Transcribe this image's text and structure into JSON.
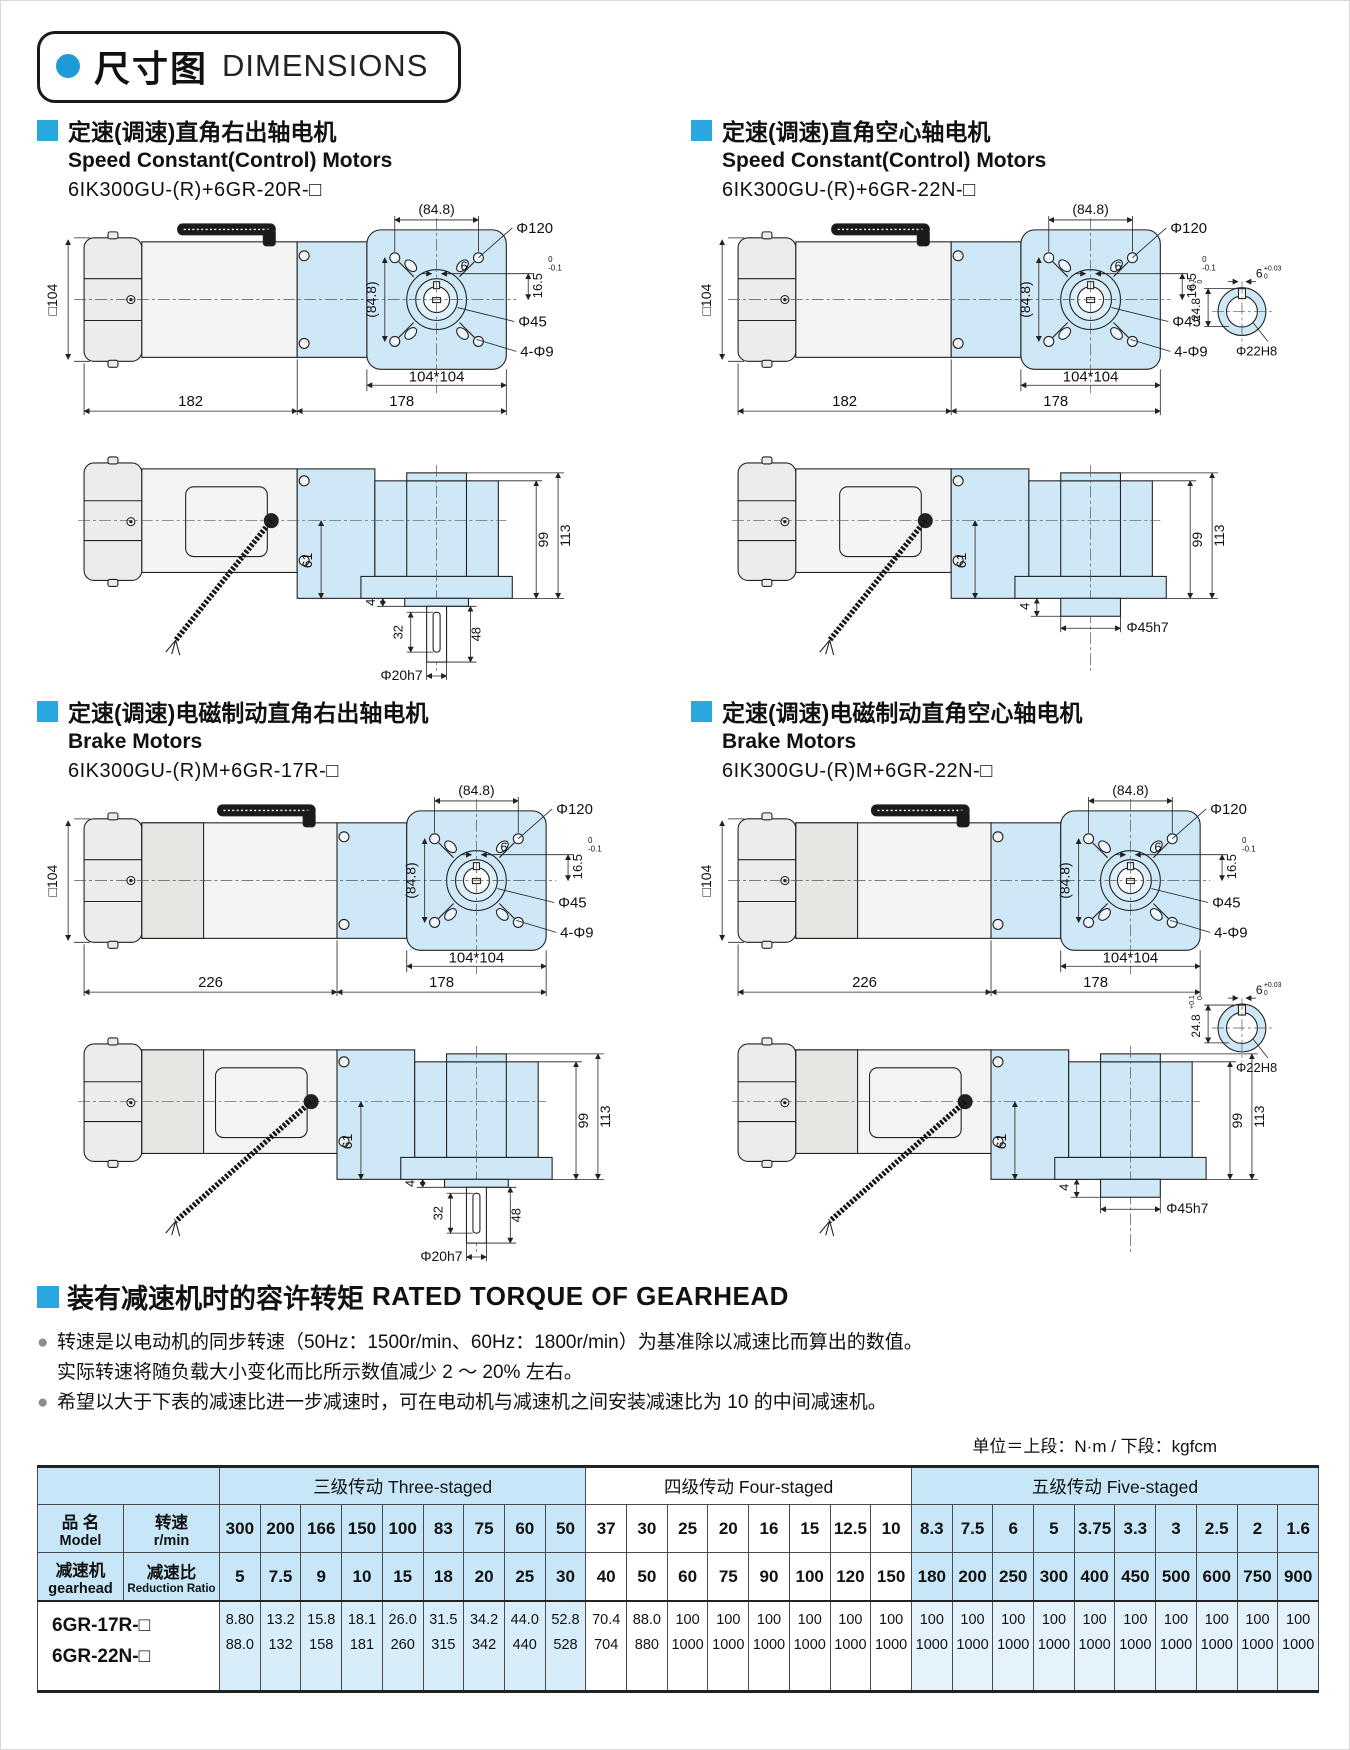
{
  "header": {
    "title_zh": "尺寸图",
    "title_en": "DIMENSIONS",
    "dot_color": "#1e9bd7"
  },
  "accent_blue": "#29a8e0",
  "gearhead_fill": "#cfe8f7",
  "sections": [
    {
      "key": "s1",
      "title_zh": "定速(调速)直角右出轴电机",
      "title_en": "Speed Constant(Control) Motors",
      "model": "6IK300GU-(R)+6GR-20R-□",
      "length_label": "182",
      "variant": {
        "brake": false,
        "hollow": false
      }
    },
    {
      "key": "s2",
      "title_zh": "定速(调速)直角空心轴电机",
      "title_en": "Speed Constant(Control) Motors",
      "model": "6IK300GU-(R)+6GR-22N-□",
      "length_label": "182",
      "variant": {
        "brake": false,
        "hollow": true
      }
    },
    {
      "key": "s3",
      "title_zh": "定速(调速)电磁制动直角右出轴电机",
      "title_en": "Brake Motors",
      "model": "6IK300GU-(R)M+6GR-17R-□",
      "length_label": "226",
      "variant": {
        "brake": true,
        "hollow": false
      }
    },
    {
      "key": "s4",
      "title_zh": "定速(调速)电磁制动直角空心轴电机",
      "title_en": "Brake Motors",
      "model": "6IK300GU-(R)M+6GR-22N-□",
      "length_label": "226",
      "variant": {
        "brake": true,
        "hollow": true
      }
    }
  ],
  "dims": {
    "sq104": "□104",
    "w848": "(84.8)",
    "dia120": "Φ120",
    "six": "6",
    "d165": "16.5",
    "d165_tol_hi": "0",
    "d165_tol_lo": "-0.1",
    "dia45": "Φ45",
    "holes": "4-Φ9",
    "plate104": "104*104",
    "len178": "178",
    "h61": "61",
    "h99": "99",
    "h113": "113",
    "s4": "4",
    "s32": "32",
    "s48": "48",
    "dia20h7": "Φ20h7",
    "dia45h7": "Φ45h7",
    "key6_tol_hi": "+0.03",
    "key6_tol_lo": "0",
    "key248": "24.8",
    "key248_tol_hi": "+0.1",
    "key248_tol_lo": "0",
    "dia22h8": "Φ22H8"
  },
  "torque": {
    "title_zh": "装有减速机时的容许转矩",
    "title_en": "RATED TORQUE OF GEARHEAD",
    "notes": [
      {
        "bullet": "●",
        "text": "转速是以电动机的同步转速（50Hz：1500r/min、60Hz：1800r/min）为基准除以减速比而算出的数值。"
      },
      {
        "bullet": "",
        "text": "实际转速将随负载大小变化而比所示数值减少 2 ～ 20% 左右。"
      },
      {
        "bullet": "●",
        "text": "希望以大于下表的减速比进一步减速时，可在电动机与减速机之间安装减速比为 10 的中间减速机。"
      }
    ],
    "unit": "单位＝上段：N·m / 下段：kgfcm",
    "table": {
      "groups": [
        {
          "label": "三级传动 Three-staged",
          "cols": 9,
          "cls": "hb"
        },
        {
          "label": "四级传动 Four-staged",
          "cols": 8,
          "cls": "hw"
        },
        {
          "label": "五级传动 Five-staged",
          "cols": 10,
          "cls": "hb"
        }
      ],
      "head": {
        "name_zh": "品  名",
        "name_en": "Model",
        "gear_zh": "减速机",
        "gear_en": "gearhead",
        "speed_zh": "转速",
        "speed_en": "r/min",
        "ratio_zh": "减速比",
        "ratio_en": "Reduction Ratio"
      },
      "speeds": [
        "300",
        "200",
        "166",
        "150",
        "100",
        "83",
        "75",
        "60",
        "50",
        "37",
        "30",
        "25",
        "20",
        "16",
        "15",
        "12.5",
        "10",
        "8.3",
        "7.5",
        "6",
        "5",
        "3.75",
        "3.3",
        "3",
        "2.5",
        "2",
        "1.6"
      ],
      "ratios": [
        "5",
        "7.5",
        "9",
        "10",
        "15",
        "18",
        "20",
        "25",
        "30",
        "40",
        "50",
        "60",
        "75",
        "90",
        "100",
        "120",
        "150",
        "180",
        "200",
        "250",
        "300",
        "400",
        "450",
        "500",
        "600",
        "750",
        "900"
      ],
      "models": [
        "6GR-17R-□",
        "6GR-22N-□"
      ],
      "nm": [
        "8.80",
        "13.2",
        "15.8",
        "18.1",
        "26.0",
        "31.5",
        "34.2",
        "44.0",
        "52.8",
        "70.4",
        "88.0",
        "100",
        "100",
        "100",
        "100",
        "100",
        "100",
        "100",
        "100",
        "100",
        "100",
        "100",
        "100",
        "100",
        "100",
        "100",
        "100"
      ],
      "kgfcm": [
        "88.0",
        "132",
        "158",
        "181",
        "260",
        "315",
        "342",
        "440",
        "528",
        "704",
        "880",
        "1000",
        "1000",
        "1000",
        "1000",
        "1000",
        "1000",
        "1000",
        "1000",
        "1000",
        "1000",
        "1000",
        "1000",
        "1000",
        "1000",
        "1000",
        "1000"
      ]
    }
  }
}
